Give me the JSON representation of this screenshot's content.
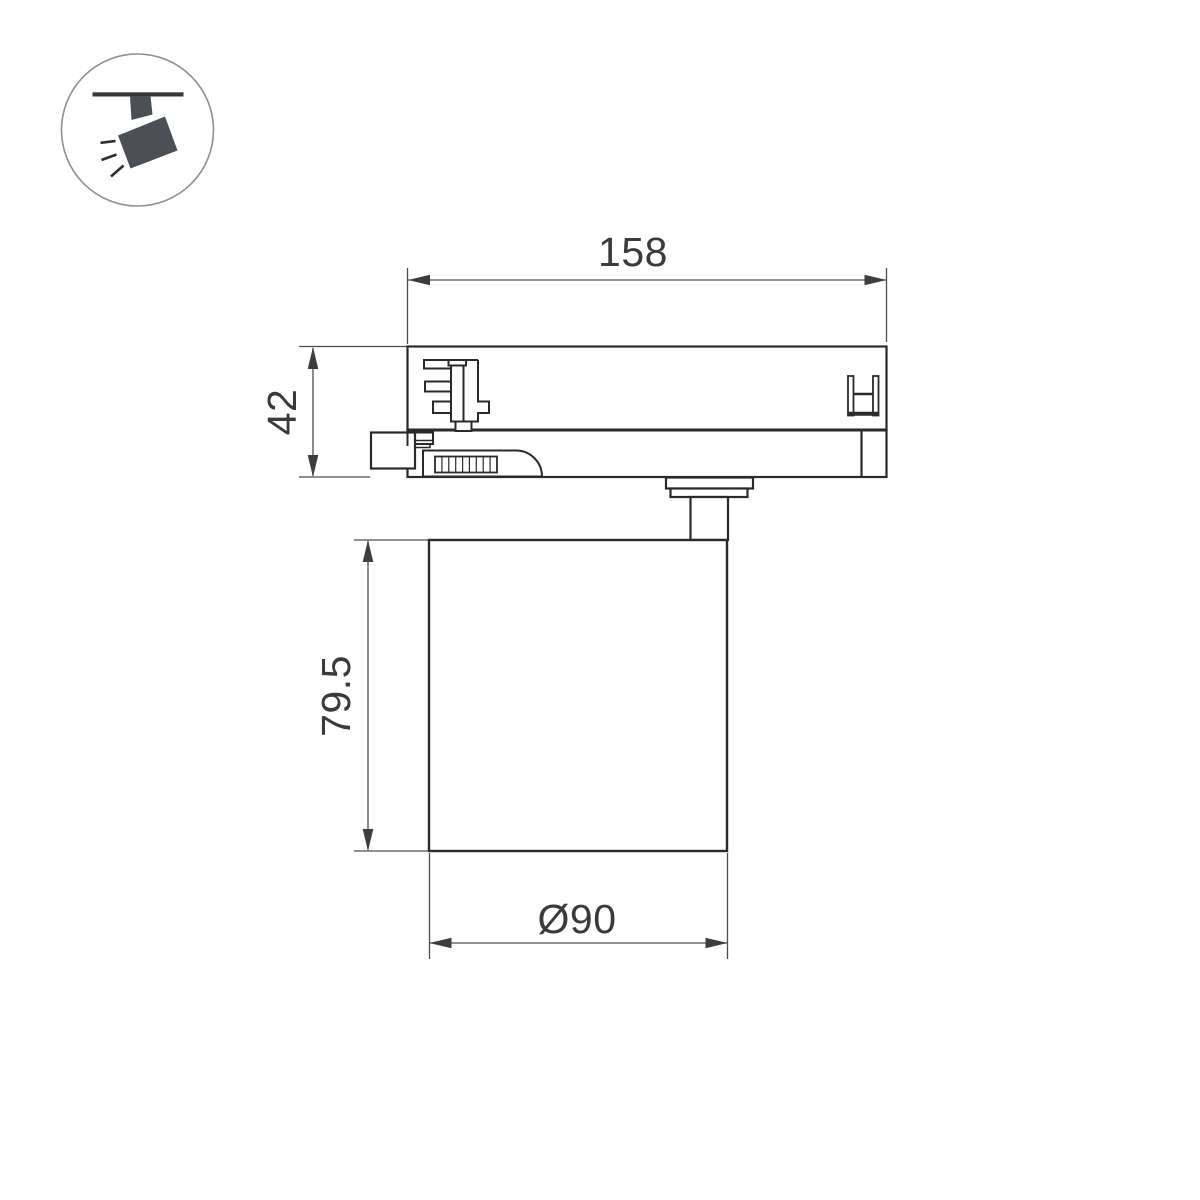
{
  "page": {
    "kind": "technical-drawing",
    "subject": "track-mounted spotlight luminaire side view",
    "background": "#ffffff"
  },
  "icon": {
    "name": "track-spotlight-icon",
    "description": "circular badge showing a spotlight hanging from a ceiling track with light rays",
    "circle_color": "#8f8f8f",
    "fill_color": "#4a5056"
  },
  "dimensions": {
    "adapter_length": "158",
    "adapter_height": "42",
    "body_height": "79.5",
    "body_diameter": "Ø90"
  },
  "colors": {
    "outline": "#2a2a2a",
    "dimension_line": "#4d4d4d",
    "arrow_fill": "#3d3d3d",
    "text": "#3a3a3a"
  }
}
